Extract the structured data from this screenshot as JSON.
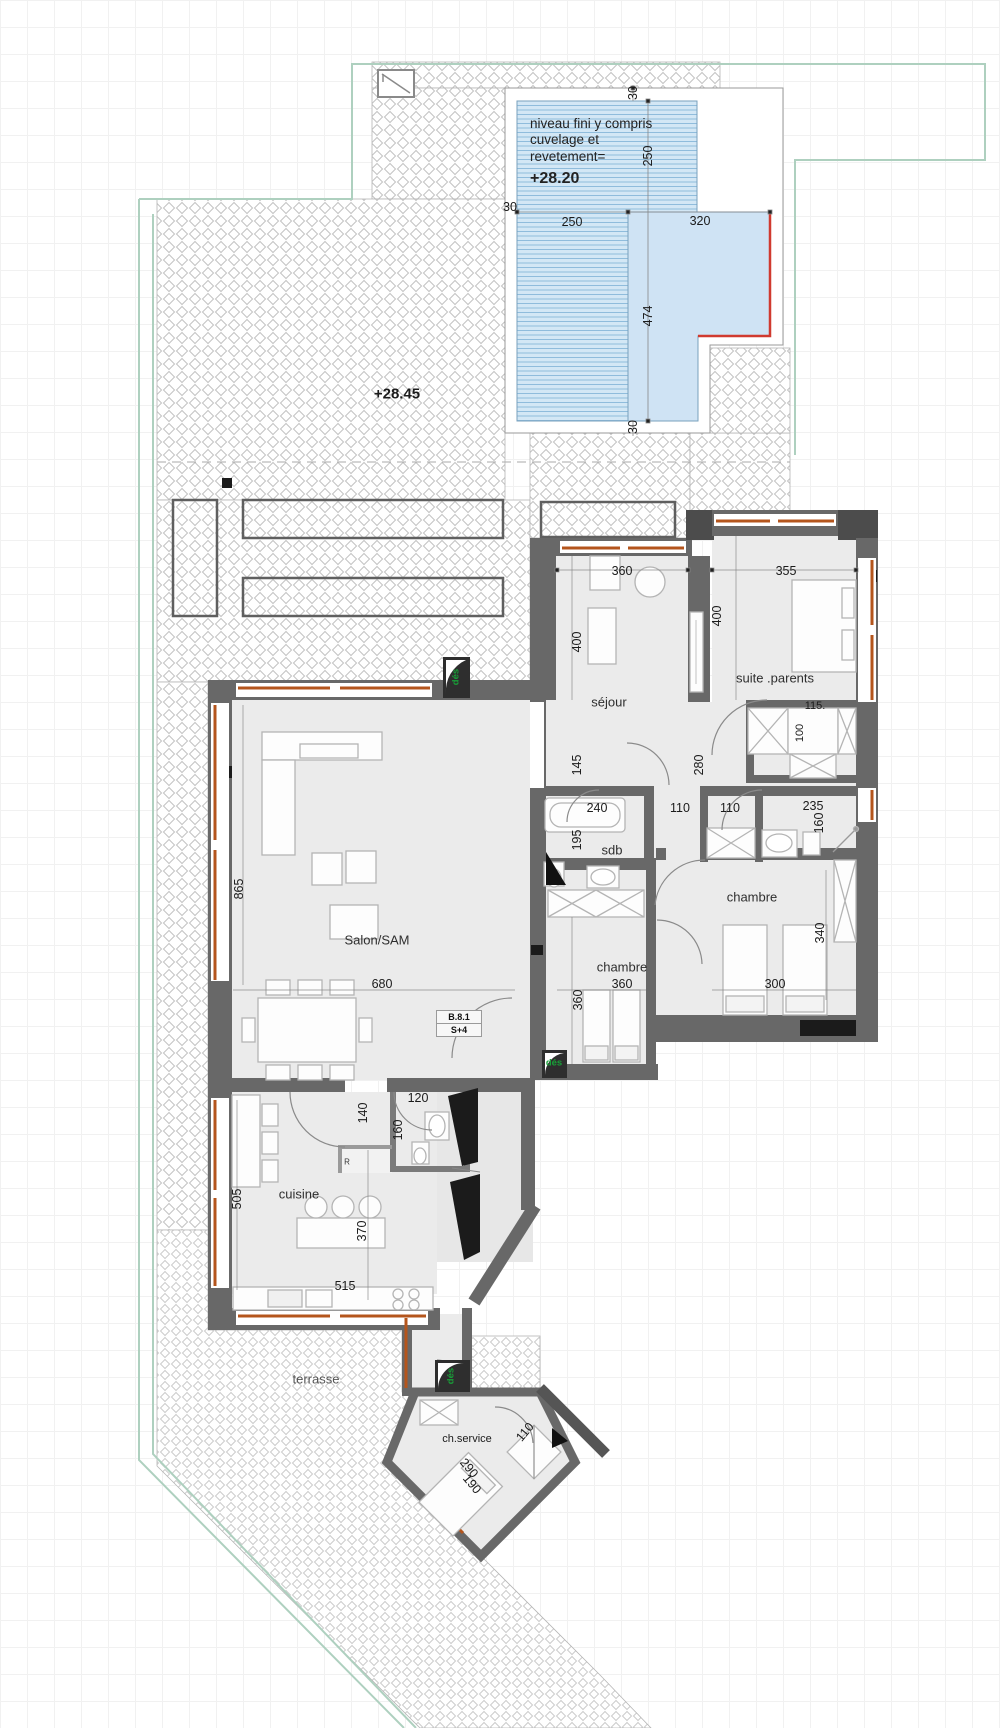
{
  "pool": {
    "note_line1": "niveau fini y compris",
    "note_line2": "cuvelage et",
    "note_line3": "revetement=",
    "level": "+28.20",
    "dim_gap_top": "30",
    "dim_gap_left": "30",
    "dim_gap_bottom": "30",
    "dim_width_upper": "250",
    "dim_w1": "250",
    "dim_w2": "320",
    "dim_length": "474"
  },
  "terrace": {
    "level": "+28.45",
    "label": "terrasse"
  },
  "rooms": {
    "sejour": "séjour",
    "suite_parents": "suite .parents",
    "salon": "Salon/SAM",
    "chambre_mid": "chambre",
    "chambre_right": "chambre",
    "sdb": "sdb",
    "cuisine": "cuisine",
    "service": "ch.service",
    "reserve": "R"
  },
  "unit": {
    "code": "B.8.1",
    "floor": "S+4"
  },
  "door_tags": {
    "des1": "dés",
    "des2": "dés",
    "des3": "dés"
  },
  "dims": {
    "sejour_w": "360",
    "sejour_h": "400",
    "suite_w": "355",
    "suite_h": "400",
    "closet_w": "115.",
    "closet_h": "100",
    "hall_door": "280",
    "sejour_low": "145",
    "tub": "240",
    "hall_a": "110",
    "hall_b": "110",
    "bath2_w": "235",
    "bath2_h": "160",
    "sdb_h": "195",
    "chambre_mid_w": "360",
    "chambre_mid_h": "360",
    "chambre_right_w": "300",
    "chambre_right_h": "340",
    "salon_h": "865",
    "salon_w": "680",
    "passage": "140",
    "wc_w": "120",
    "wc_h": "160",
    "cuisine_h": "505",
    "island": "370",
    "cuisine_w": "515",
    "service_w": "110",
    "service_d1": "290",
    "service_d2": "190"
  },
  "colors": {
    "wall": "#686868",
    "wall_dark": "#4c4c4c",
    "black": "#1b1b1b",
    "window_frame": "#b4551c",
    "pool_fill": "#d3e7f5",
    "pool_stripe": "#8fbcdc",
    "red_edge": "#d03a2f",
    "door_tag_green": "#18a038",
    "hatch_line": "#c3c3c3",
    "boundary_teal": "#aed0bf",
    "floor": "#ebebeb"
  }
}
